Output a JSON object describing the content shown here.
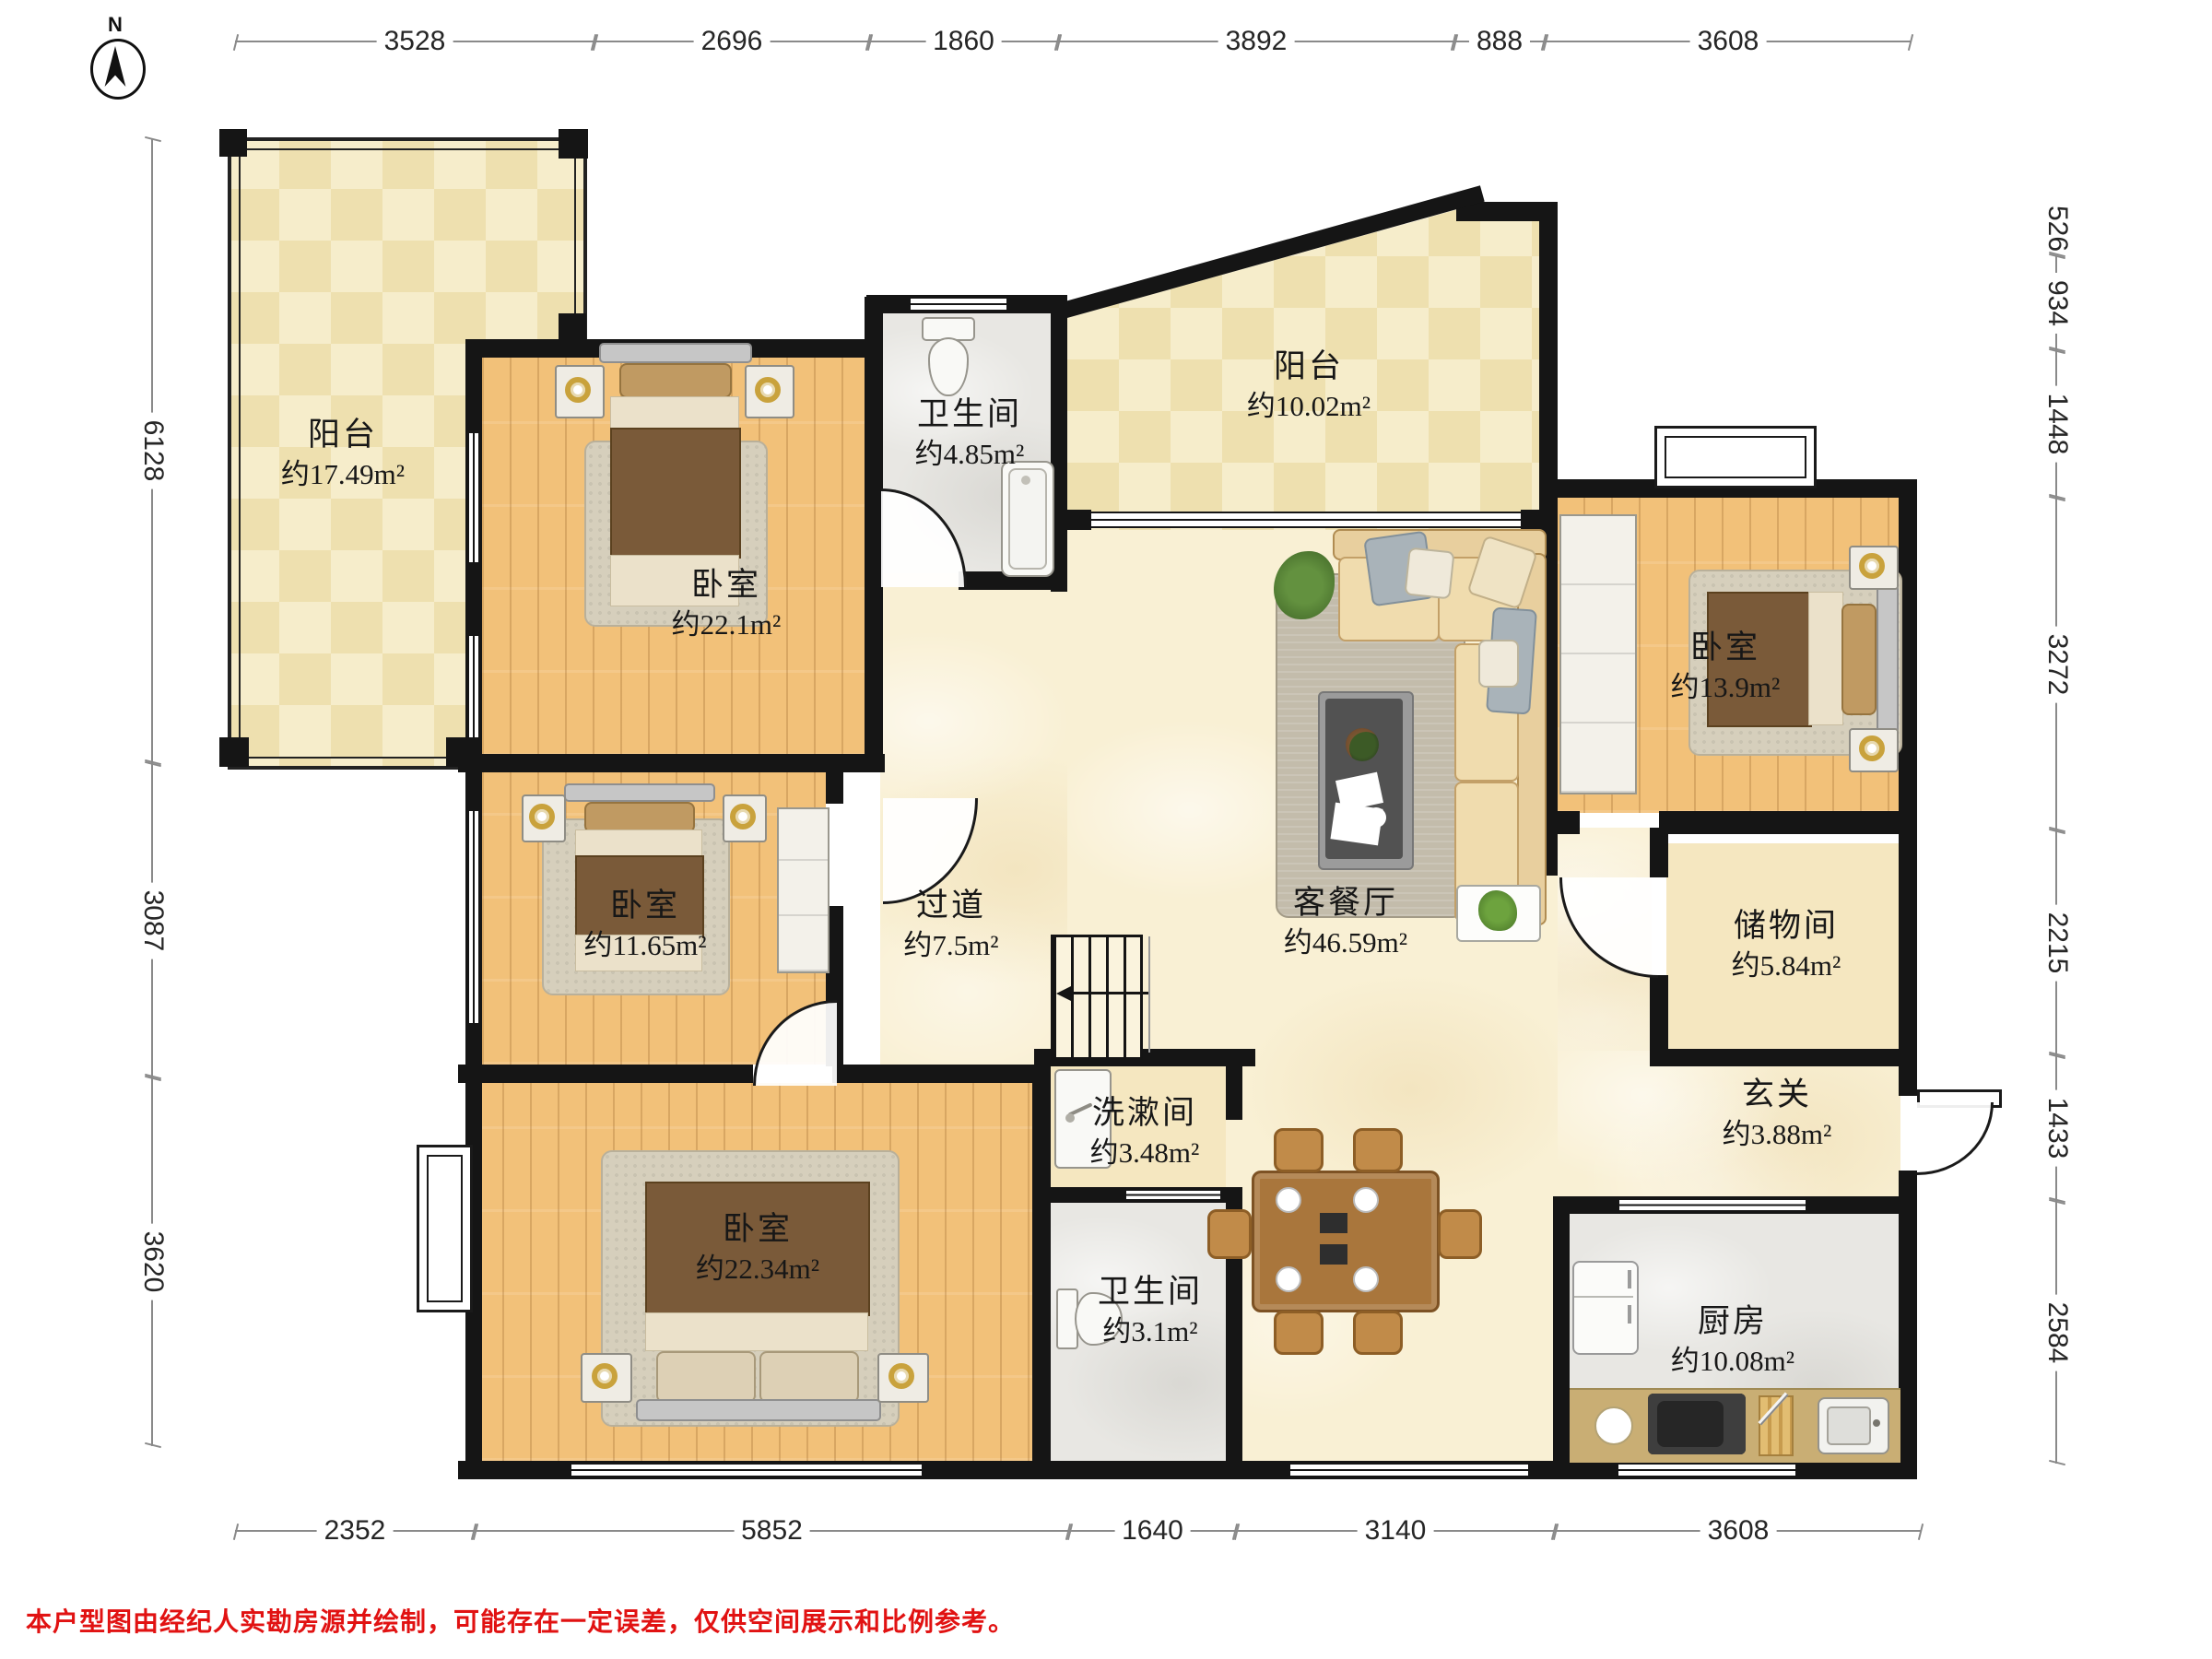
{
  "compass": {
    "label": "N"
  },
  "dimensions": {
    "top": [
      "3528",
      "2696",
      "1860",
      "3892",
      "888",
      "3608"
    ],
    "bottom": [
      "2352",
      "5852",
      "1640",
      "3140",
      "3608"
    ],
    "left": [
      "6128",
      "3087",
      "3620"
    ],
    "right": [
      "526",
      "934",
      "1448",
      "3272",
      "2215",
      "1433",
      "2584"
    ]
  },
  "rooms": [
    {
      "name": "阳台",
      "area": "约17.49m²"
    },
    {
      "name": "卧室",
      "area": "约22.1m²"
    },
    {
      "name": "卫生间",
      "area": "约4.85m²"
    },
    {
      "name": "阳台",
      "area": "约10.02m²"
    },
    {
      "name": "卧室",
      "area": "约13.9m²"
    },
    {
      "name": "卧室",
      "area": "约11.65m²"
    },
    {
      "name": "过道",
      "area": "约7.5m²"
    },
    {
      "name": "客餐厅",
      "area": "约46.59m²"
    },
    {
      "name": "储物间",
      "area": "约5.84m²"
    },
    {
      "name": "玄关",
      "area": "约3.88m²"
    },
    {
      "name": "洗漱间",
      "area": "约3.48m²"
    },
    {
      "name": "卧室",
      "area": "约22.34m²"
    },
    {
      "name": "卫生间",
      "area": "约3.1m²"
    },
    {
      "name": "厨房",
      "area": "约10.08m²"
    }
  ],
  "disclaimer": "本户型图由经纪人实勘房源并绘制，可能存在一定误差，仅供空间展示和比例参考。"
}
